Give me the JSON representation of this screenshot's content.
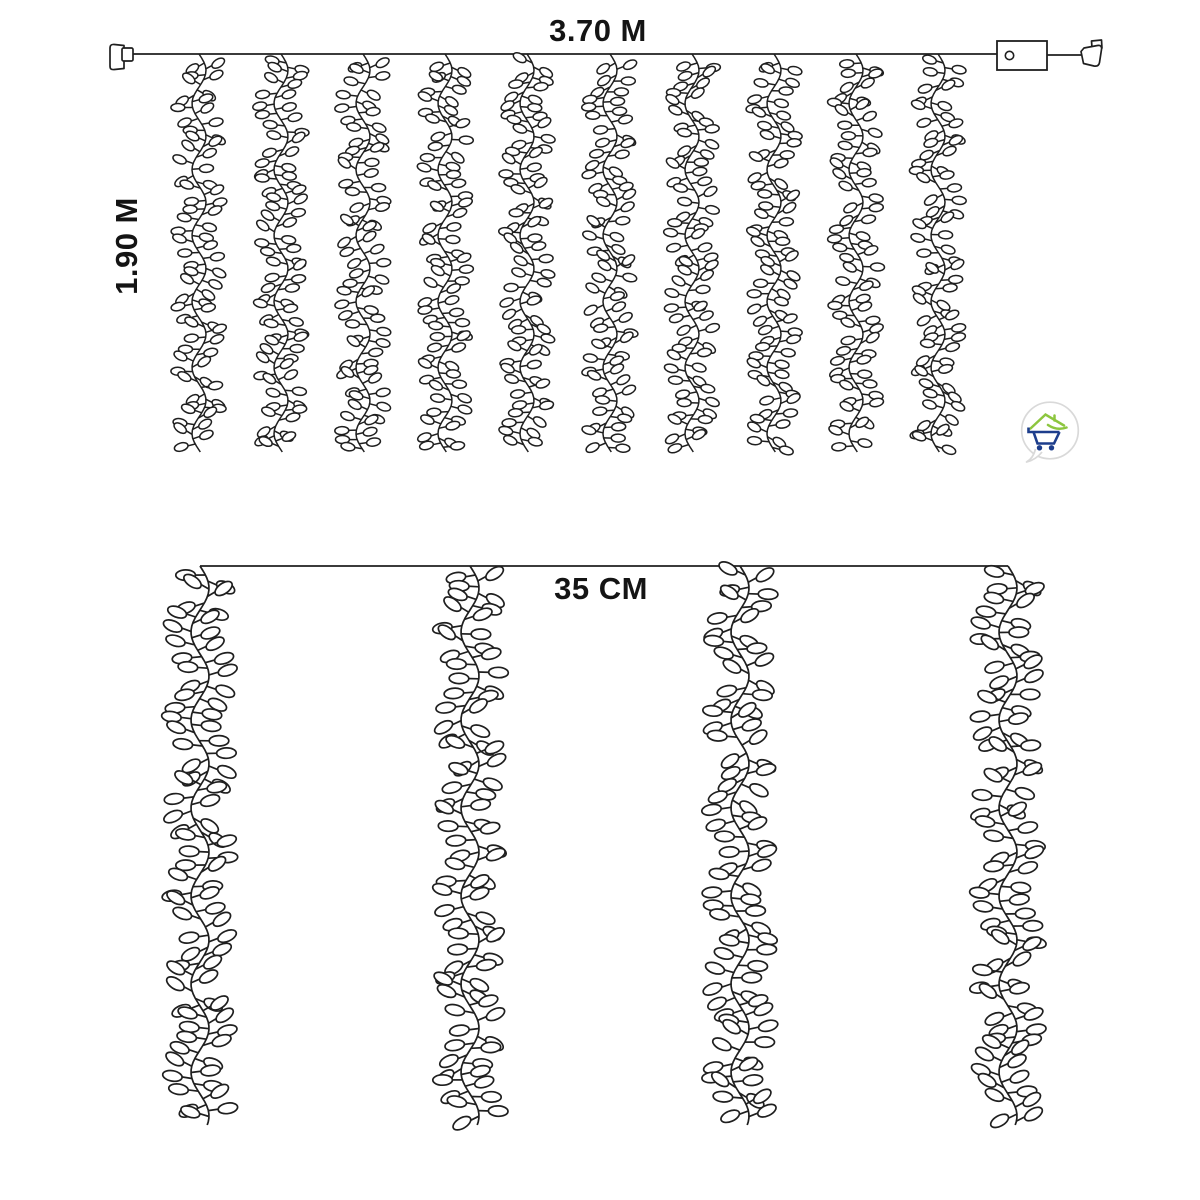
{
  "labels": {
    "top_width": "3.70 M",
    "left_height": "1.90 M",
    "strand_spacing": "35 CM"
  },
  "colors": {
    "line": "#1f1f1f",
    "text": "#141414",
    "background": "#ffffff",
    "logo_green": "#8dc63f",
    "logo_blue": "#1d3d8c",
    "logo_bubble": "#d9d9d9"
  },
  "diagram": {
    "top_curtain": {
      "strand_count": 10,
      "wire": {
        "y": 54,
        "x1": 132,
        "x2": 997
      },
      "strand_xs": [
        199,
        281,
        363,
        445,
        527,
        610,
        692,
        774,
        856,
        938
      ],
      "strand_y_top": 54,
      "strand_y_bottom": 452,
      "strand_style": {
        "amp": 7,
        "period": 66,
        "step": 5.3,
        "branch": 9,
        "rx": 7,
        "ry": 4,
        "lw": 1.5
      },
      "has_left_plug": true,
      "has_right_plug": true,
      "controller": {
        "x": 997,
        "y": 41,
        "w": 50,
        "h": 29,
        "dot_r": 4.2
      }
    },
    "bottom_detail": {
      "strand_count": 4,
      "wire": {
        "y": 566,
        "x1": 200,
        "x2": 1008
      },
      "strand_xs": [
        200,
        470,
        740,
        1008
      ],
      "strand_y_top": 566,
      "strand_y_bottom": 1125,
      "strand_style": {
        "amp": 9,
        "period": 88,
        "step": 6.6,
        "branch": 12,
        "rx": 9.8,
        "ry": 5.2,
        "lw": 1.7
      }
    }
  }
}
